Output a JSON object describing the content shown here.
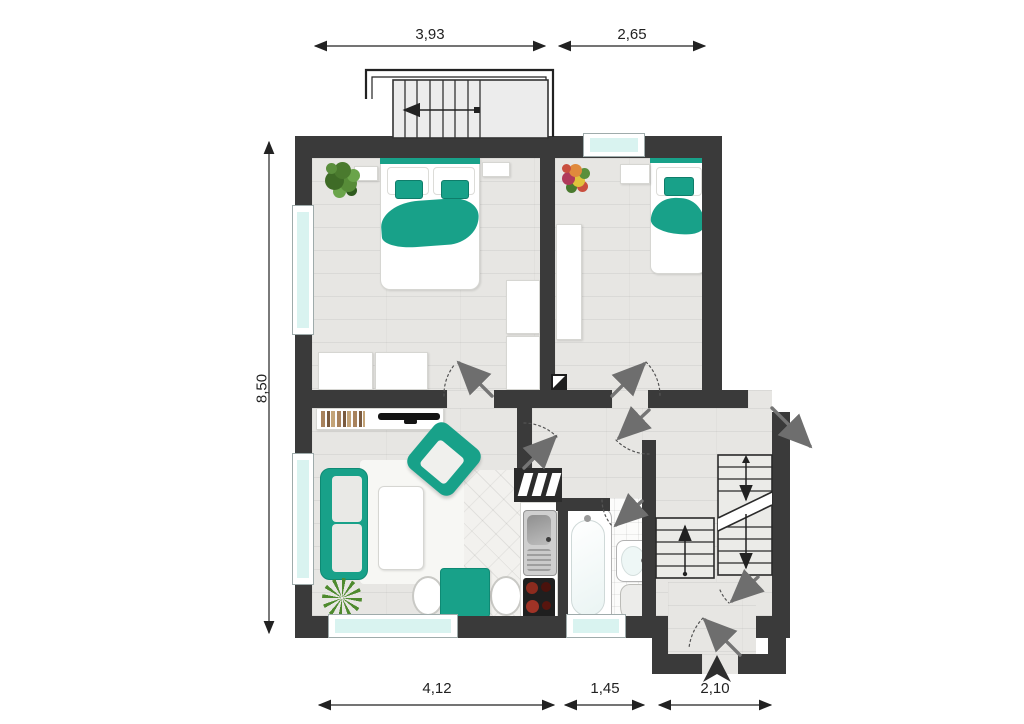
{
  "plan": {
    "title_semantic": "apartment-floor-plan",
    "dimensions_top": [
      {
        "label": "3,93"
      },
      {
        "label": "2,65"
      }
    ],
    "dimension_left": {
      "label": "8,50"
    },
    "dimensions_bottom": [
      {
        "label": "4,12"
      },
      {
        "label": "1,45"
      },
      {
        "label": "2,10"
      }
    ],
    "colors": {
      "wall": "#3a3a3a",
      "accent_teal": "#18a189",
      "window_glass": "#d9f3f0",
      "floor_wood": "#e7e6e3",
      "floor_tile": "#fcfcfb",
      "floor_marble": "#f2f1ee",
      "door_arrow": "#757575",
      "dimension_text": "#222222"
    },
    "icons": {
      "furniture": [
        "double-bed",
        "single-bed",
        "wardrobe",
        "nightstand",
        "sideboard-with-books",
        "tv",
        "sofa",
        "armchair",
        "coffee-table",
        "rug",
        "dining-table",
        "dining-chair",
        "kitchen-sink",
        "stove",
        "wall-cabinets",
        "bathtub",
        "bathroom-sink",
        "toilet",
        "plant",
        "flower-plant",
        "palm-plant"
      ],
      "symbols": [
        "door-swing-arrow",
        "stair-up-arrow",
        "stair-break-line",
        "entrance-arrow",
        "ventilation-shaft",
        "dimension-arrow",
        "exterior-stairs",
        "window"
      ]
    }
  }
}
